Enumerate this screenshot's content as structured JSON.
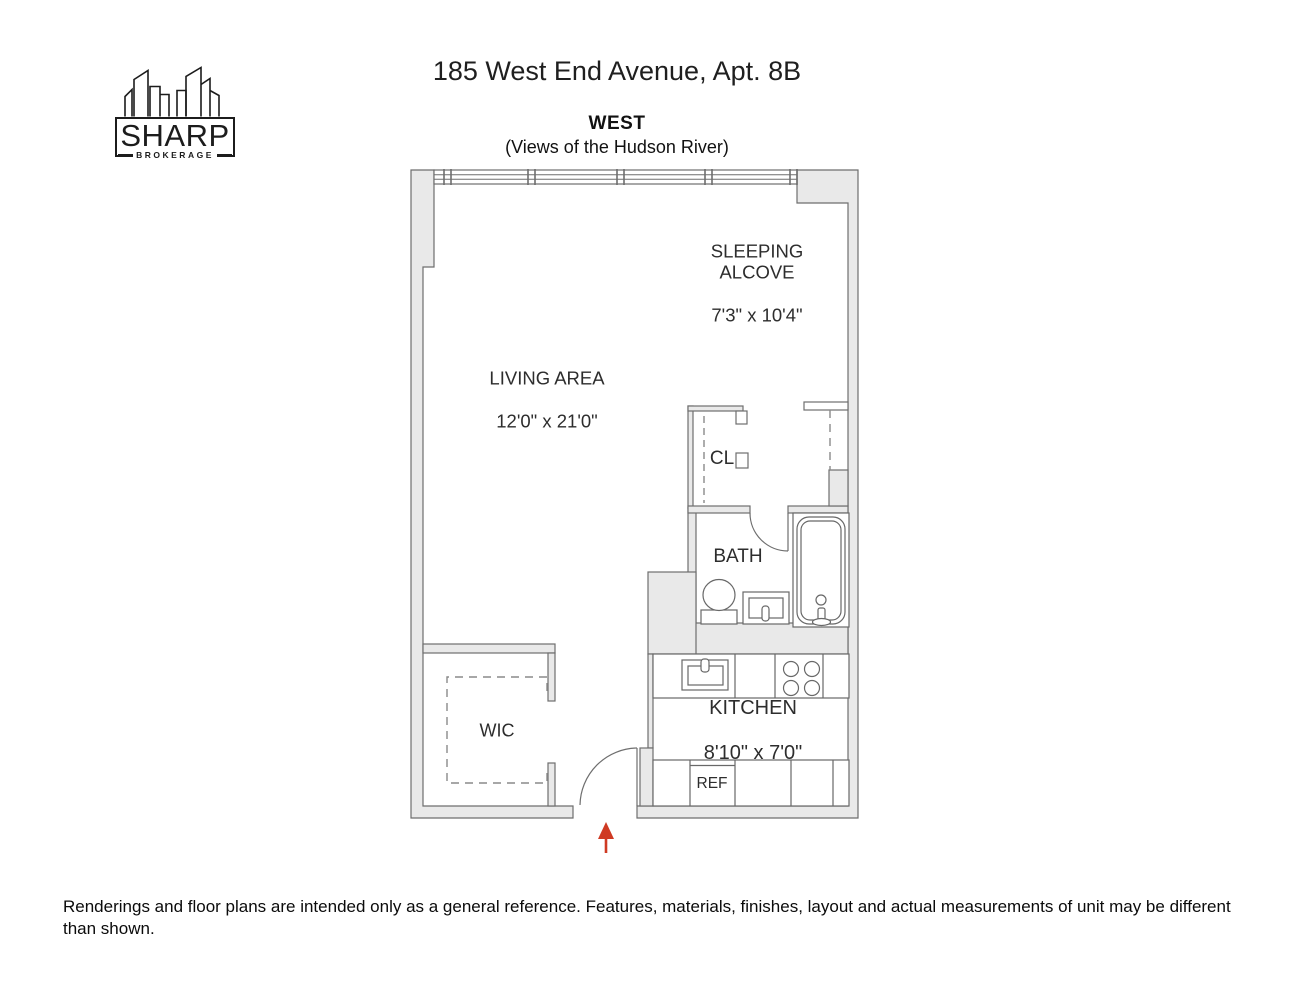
{
  "logo": {
    "brand": "SHARP",
    "tagline": "BROKERAGE"
  },
  "header": {
    "title": "185 West End Avenue, Apt. 8B",
    "orientation_label": "WEST",
    "orientation_note": "(Views of the Hudson River)"
  },
  "floorplan": {
    "living_area": {
      "name": "LIVING AREA",
      "dimensions": "12'0\" x 21'0\""
    },
    "sleeping_alcove": {
      "name": "SLEEPING\nALCOVE",
      "dimensions": "7'3\" x 10'4\""
    },
    "closet": {
      "name": "CL"
    },
    "bath": {
      "name": "BATH"
    },
    "walk_in_closet": {
      "name": "WIC"
    },
    "kitchen": {
      "name": "KITCHEN",
      "dimensions": "8'10\" x 7'0\""
    },
    "refrigerator": {
      "name": "REF"
    }
  },
  "footer": {
    "disclaimer": "Renderings and floor plans are intended only as a general reference. Features, materials, finishes, layout and actual measurements of unit may be different than shown."
  },
  "colors": {
    "wall_fill": "#e9e9e9",
    "wall_stroke": "#6e6e6e",
    "fixture_stroke": "#686868",
    "label_text": "#2d2d2d",
    "entry_arrow": "#cf3a23",
    "logo_ink": "#1c1c1c"
  }
}
